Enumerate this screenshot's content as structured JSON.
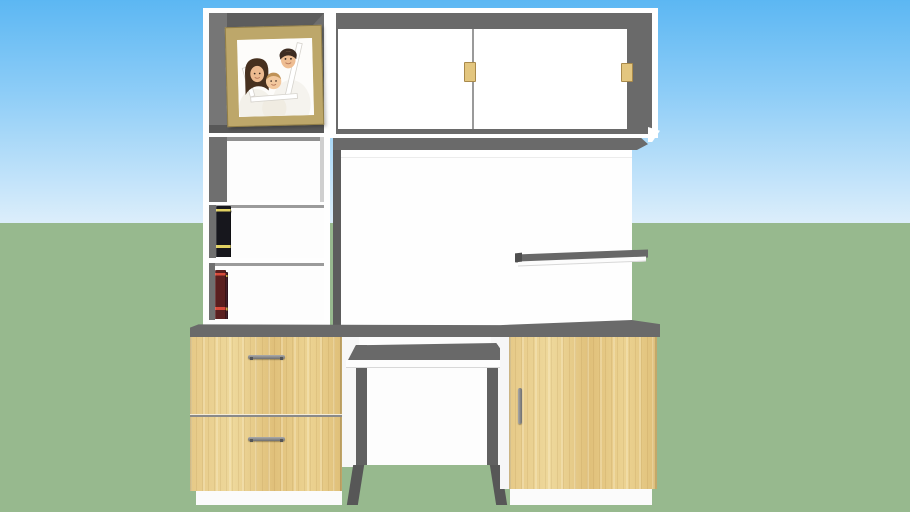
{
  "scene": {
    "type": "3d-furniture-model-render",
    "subject": "white computer desk hutch with oak drawers, bookshelves and family photo",
    "background": {
      "sky_visible": true,
      "ground_visible": true
    }
  },
  "colors": {
    "sky_top": "#5cb7f3",
    "sky_mid": "#8ecdf7",
    "sky_horizon": "#dceefb",
    "ground": "#97b98e",
    "cabinet_gray": "#6a6a6a",
    "cabinet_gray_dark": "#5d5d5d",
    "wood_mid": "#e2c483",
    "handle_tan": "#e3c67f",
    "handle_tan_border": "#a98a4b",
    "frame_tan": "#bda76a",
    "divider_line": "#9a9a9a",
    "metal_gray": "#8a8a8a",
    "panel_white": "#ffffff"
  },
  "furniture": {
    "hutch": {
      "photo_frame": {
        "content": "family portrait (father, mother, baby holding a white frame)",
        "frame_color": "#bda76a"
      },
      "sliding_door_cabinet": {
        "doors": 2,
        "handles": 2,
        "handle_color": "#e3c67f"
      },
      "open_shelf_compartments": 1,
      "book_shelf_rows": 2,
      "wall_shelf_count": 1
    },
    "desk": {
      "left_drawer_unit": {
        "drawers": 2,
        "handle_style": "horizontal metal bar"
      },
      "keyboard_tray": {
        "present": true
      },
      "right_cabinet": {
        "doors": 1,
        "handle_style": "vertical metal bar"
      }
    }
  },
  "books": {
    "shelf1": [
      {
        "color": "#7cc3e6",
        "w": 13,
        "h": 38,
        "tilt": 0,
        "stripe": "#f2f6f8"
      },
      {
        "color": "#e9e2cf",
        "w": 10,
        "h": 42,
        "tilt": 0,
        "stripe": "#b3aa8c"
      },
      {
        "color": "#b23b2e",
        "w": 9,
        "h": 44,
        "tilt": 0,
        "stripe": "#6e1d15"
      },
      {
        "color": "#2e3038",
        "w": 10,
        "h": 46,
        "tilt": 0,
        "stripe": "#c9b94c"
      },
      {
        "color": "#55604f",
        "w": 7,
        "h": 43,
        "tilt": 0,
        "stripe": null
      },
      {
        "color": "#ddd3b2",
        "w": 8,
        "h": 44,
        "tilt": 0,
        "stripe": "#9a8e68"
      },
      {
        "color": "#5d7b50",
        "w": 9,
        "h": 45,
        "tilt": 0,
        "stripe": "#cdd9ba"
      },
      {
        "color": "#232320",
        "w": 9,
        "h": 47,
        "tilt": 8,
        "stripe": "#d9c94f"
      },
      {
        "color": "#17171d",
        "w": 15,
        "h": 51,
        "tilt": 0,
        "stripe": "#e1d162"
      }
    ],
    "shelf2": [
      {
        "color": "#45202c",
        "w": 13,
        "h": 47,
        "tilt": 0,
        "stripe": "#c9a84f"
      },
      {
        "color": "#6b2a28",
        "w": 9,
        "h": 44,
        "tilt": 0,
        "stripe": "#e6d6ae"
      },
      {
        "color": "#d8c0b0",
        "w": 9,
        "h": 43,
        "tilt": 0,
        "stripe": "#8a4a50"
      },
      {
        "color": "#7a3040",
        "w": 10,
        "h": 45,
        "tilt": 0,
        "stripe": "#d8a8b0"
      },
      {
        "color": "#26222a",
        "w": 8,
        "h": 47,
        "tilt": 0,
        "stripe": "#cf7a33"
      },
      {
        "color": "#c08a4a",
        "w": 7,
        "h": 43,
        "tilt": 0,
        "stripe": "#5e3a1a"
      },
      {
        "color": "#ece6d2",
        "w": 9,
        "h": 42,
        "tilt": 0,
        "stripe": "#a89467"
      },
      {
        "color": "#8a2420",
        "w": 8,
        "h": 44,
        "tilt": 0,
        "stripe": "#e8d0c0"
      },
      {
        "color": "#26242a",
        "w": 6,
        "h": 45,
        "tilt": 0,
        "stripe": null
      },
      {
        "color": "#b03028",
        "w": 9,
        "h": 46,
        "tilt": 0,
        "stripe": "#ecd9a8"
      },
      {
        "color": "#5a1f1f",
        "w": 11,
        "h": 49,
        "tilt": 0,
        "stripe": "#d84a3a"
      }
    ]
  }
}
